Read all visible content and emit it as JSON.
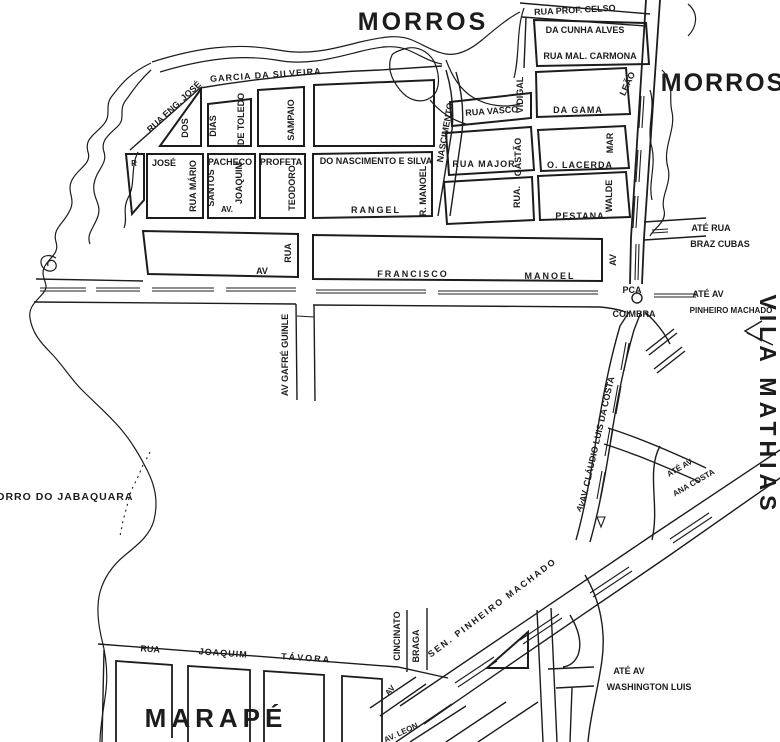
{
  "colors": {
    "ink": "#1c1c1c",
    "paper": "#ffffff"
  },
  "districts": [
    {
      "n": "morros-top",
      "t": "MORROS",
      "x": 423,
      "y": 30,
      "s": 25,
      "ls": 3
    },
    {
      "n": "morros-right",
      "t": "MORROS",
      "x": 723,
      "y": 91,
      "s": 25,
      "ls": 2
    },
    {
      "n": "vila-mathias",
      "t": "VILA MATHIAS",
      "x": 760,
      "y": 405,
      "s": 23,
      "ls": 5,
      "r": 90
    },
    {
      "n": "marape",
      "t": "MARAPÉ",
      "x": 216,
      "y": 727,
      "s": 26,
      "ls": 5
    },
    {
      "n": "morro-do-jabaquara",
      "t": "MORRO DO JABAQUARA",
      "x": 60,
      "y": 500,
      "s": 10.5,
      "ls": 1
    }
  ],
  "streets": [
    {
      "t": "RUA PROF. CELSO",
      "x": 575,
      "y": 13,
      "s": 9,
      "r": -3
    },
    {
      "t": "DA CUNHA ALVES",
      "x": 585,
      "y": 33,
      "s": 9
    },
    {
      "t": "RUA MAL. CARMONA",
      "x": 590,
      "y": 59,
      "s": 9
    },
    {
      "t": "GARCIA DA SILVEIRA",
      "x": 266,
      "y": 78,
      "s": 9,
      "r": -4,
      "ls": 1
    },
    {
      "t": "RUA ENG. JOSÉ",
      "x": 176,
      "y": 109,
      "s": 9,
      "r": -43
    },
    {
      "t": "DOS",
      "x": 188,
      "y": 128,
      "s": 9,
      "r": -90
    },
    {
      "t": "DIAS",
      "x": 216,
      "y": 126,
      "s": 9,
      "r": -90
    },
    {
      "t": "DE TOLEDO",
      "x": 244,
      "y": 119,
      "s": 9,
      "r": -90
    },
    {
      "t": "SAMPAIO",
      "x": 294,
      "y": 120,
      "s": 9,
      "r": -90
    },
    {
      "t": "R",
      "x": 134,
      "y": 166,
      "s": 8
    },
    {
      "t": "JOSÉ",
      "x": 164,
      "y": 166,
      "s": 9
    },
    {
      "t": "RUA MÁRIO",
      "x": 196,
      "y": 186,
      "s": 9,
      "r": -90
    },
    {
      "t": "PACHECO",
      "x": 230,
      "y": 165,
      "s": 9
    },
    {
      "t": "SANTOS",
      "x": 214,
      "y": 188,
      "s": 9,
      "r": -90
    },
    {
      "t": "AV.",
      "x": 227,
      "y": 212,
      "s": 8
    },
    {
      "t": "JOAQUIM",
      "x": 242,
      "y": 183,
      "s": 9,
      "r": -90
    },
    {
      "t": "PROFETA",
      "x": 281,
      "y": 165,
      "s": 9
    },
    {
      "t": "TEODORO",
      "x": 295,
      "y": 188,
      "s": 9,
      "r": -90
    },
    {
      "t": "DO NASCIMENTO E SILVA",
      "x": 376,
      "y": 164,
      "s": 9
    },
    {
      "t": "RANGEL",
      "x": 376,
      "y": 213,
      "s": 9,
      "ls": 2
    },
    {
      "t": "R. MANOEL",
      "x": 426,
      "y": 191,
      "s": 9,
      "r": -90
    },
    {
      "t": "NASCIMENTO",
      "x": 448,
      "y": 133,
      "s": 9,
      "r": -80
    },
    {
      "t": "RUA VASCO",
      "x": 492,
      "y": 114,
      "s": 9,
      "r": -4
    },
    {
      "t": "VIDIGAL",
      "x": 523,
      "y": 95,
      "s": 9,
      "r": -90
    },
    {
      "t": "DA GAMA",
      "x": 578,
      "y": 113,
      "s": 9,
      "ls": 1
    },
    {
      "t": "LEÃO",
      "x": 630,
      "y": 85,
      "s": 9,
      "r": -65
    },
    {
      "t": "RUA MAJOR",
      "x": 484,
      "y": 167,
      "s": 9,
      "ls": 1
    },
    {
      "t": "GASTÃO",
      "x": 521,
      "y": 157,
      "s": 9,
      "r": -90
    },
    {
      "t": "O. LACERDA",
      "x": 580,
      "y": 168,
      "s": 9,
      "ls": 1
    },
    {
      "t": "MAR",
      "x": 613,
      "y": 143,
      "s": 9,
      "r": -90
    },
    {
      "t": "RUA.",
      "x": 520,
      "y": 197,
      "s": 9,
      "r": -90
    },
    {
      "t": "PESTANA",
      "x": 580,
      "y": 219,
      "s": 9,
      "ls": 1
    },
    {
      "t": "WALDE",
      "x": 612,
      "y": 196,
      "s": 9,
      "r": -90
    },
    {
      "t": "AV",
      "x": 262,
      "y": 274,
      "s": 9
    },
    {
      "t": "RUA",
      "x": 291,
      "y": 253,
      "s": 9,
      "r": -90
    },
    {
      "t": "FRANCISCO",
      "x": 413,
      "y": 277,
      "s": 9,
      "ls": 2
    },
    {
      "t": "MANOEL",
      "x": 550,
      "y": 279,
      "s": 9,
      "ls": 2
    },
    {
      "n": "av-vertical",
      "t": "AV",
      "x": 616,
      "y": 260,
      "s": 9,
      "r": -90
    },
    {
      "t": "AV GAFRÉ GUINLE",
      "x": 288,
      "y": 355,
      "s": 9,
      "r": -90
    },
    {
      "t": "AV. CLÁUDIO LUIS DA COSTA",
      "x": 600,
      "y": 440,
      "s": 9,
      "r": -77
    },
    {
      "n": "av-claudio-stub",
      "t": "AV",
      "x": 583,
      "y": 508,
      "s": 8,
      "r": -55
    },
    {
      "t": "SEN. PINHEIRO MACHADO",
      "x": 494,
      "y": 610,
      "s": 9,
      "r": -37,
      "ls": 2
    },
    {
      "t": "CINCINATO",
      "x": 400,
      "y": 636,
      "s": 9,
      "r": -90
    },
    {
      "t": "BRAGA",
      "x": 419,
      "y": 646,
      "s": 9,
      "r": -90
    },
    {
      "n": "av-leon-start",
      "t": "AV",
      "x": 392,
      "y": 692,
      "s": 8,
      "r": -50
    },
    {
      "t": "RUA",
      "x": 150,
      "y": 652,
      "s": 9,
      "r": 4
    },
    {
      "t": "JOAQUIM",
      "x": 223,
      "y": 656,
      "s": 9,
      "r": 4,
      "ls": 1
    },
    {
      "t": "TÁVORA",
      "x": 306,
      "y": 661,
      "s": 9,
      "r": 4,
      "ls": 2
    },
    {
      "t": "AV. LEON",
      "x": 402,
      "y": 735,
      "s": 8,
      "r": -25
    }
  ],
  "destinations": [
    {
      "n": "ate-rua",
      "t": "ATÉ RUA",
      "x": 711,
      "y": 231,
      "s": 9
    },
    {
      "n": "braz-cubas",
      "t": "BRAZ CUBAS",
      "x": 720,
      "y": 247,
      "s": 9
    },
    {
      "n": "ate-av-1",
      "t": "ATÉ AV",
      "x": 708,
      "y": 297,
      "s": 9
    },
    {
      "n": "pinheiro-machado",
      "t": "PINHEIRO MACHADO",
      "x": 731,
      "y": 313,
      "s": 8
    },
    {
      "n": "ate-av-2",
      "t": "ATÉ AV",
      "x": 681,
      "y": 470,
      "s": 8,
      "r": -30
    },
    {
      "n": "ana-costa",
      "t": "ANA COSTA",
      "x": 695,
      "y": 485,
      "s": 8,
      "r": -30
    },
    {
      "n": "ate-av-3",
      "t": "ATÉ AV",
      "x": 629,
      "y": 674,
      "s": 9
    },
    {
      "n": "washington-luis",
      "t": "WASHINGTON LUIS",
      "x": 649,
      "y": 690,
      "s": 9
    }
  ],
  "landmarks": [
    {
      "n": "praca-abbrev",
      "t": "PCA",
      "x": 632,
      "y": 293,
      "s": 9
    },
    {
      "n": "praca-coimbra",
      "t": "COIMBRA",
      "x": 634,
      "y": 317,
      "s": 9
    }
  ]
}
